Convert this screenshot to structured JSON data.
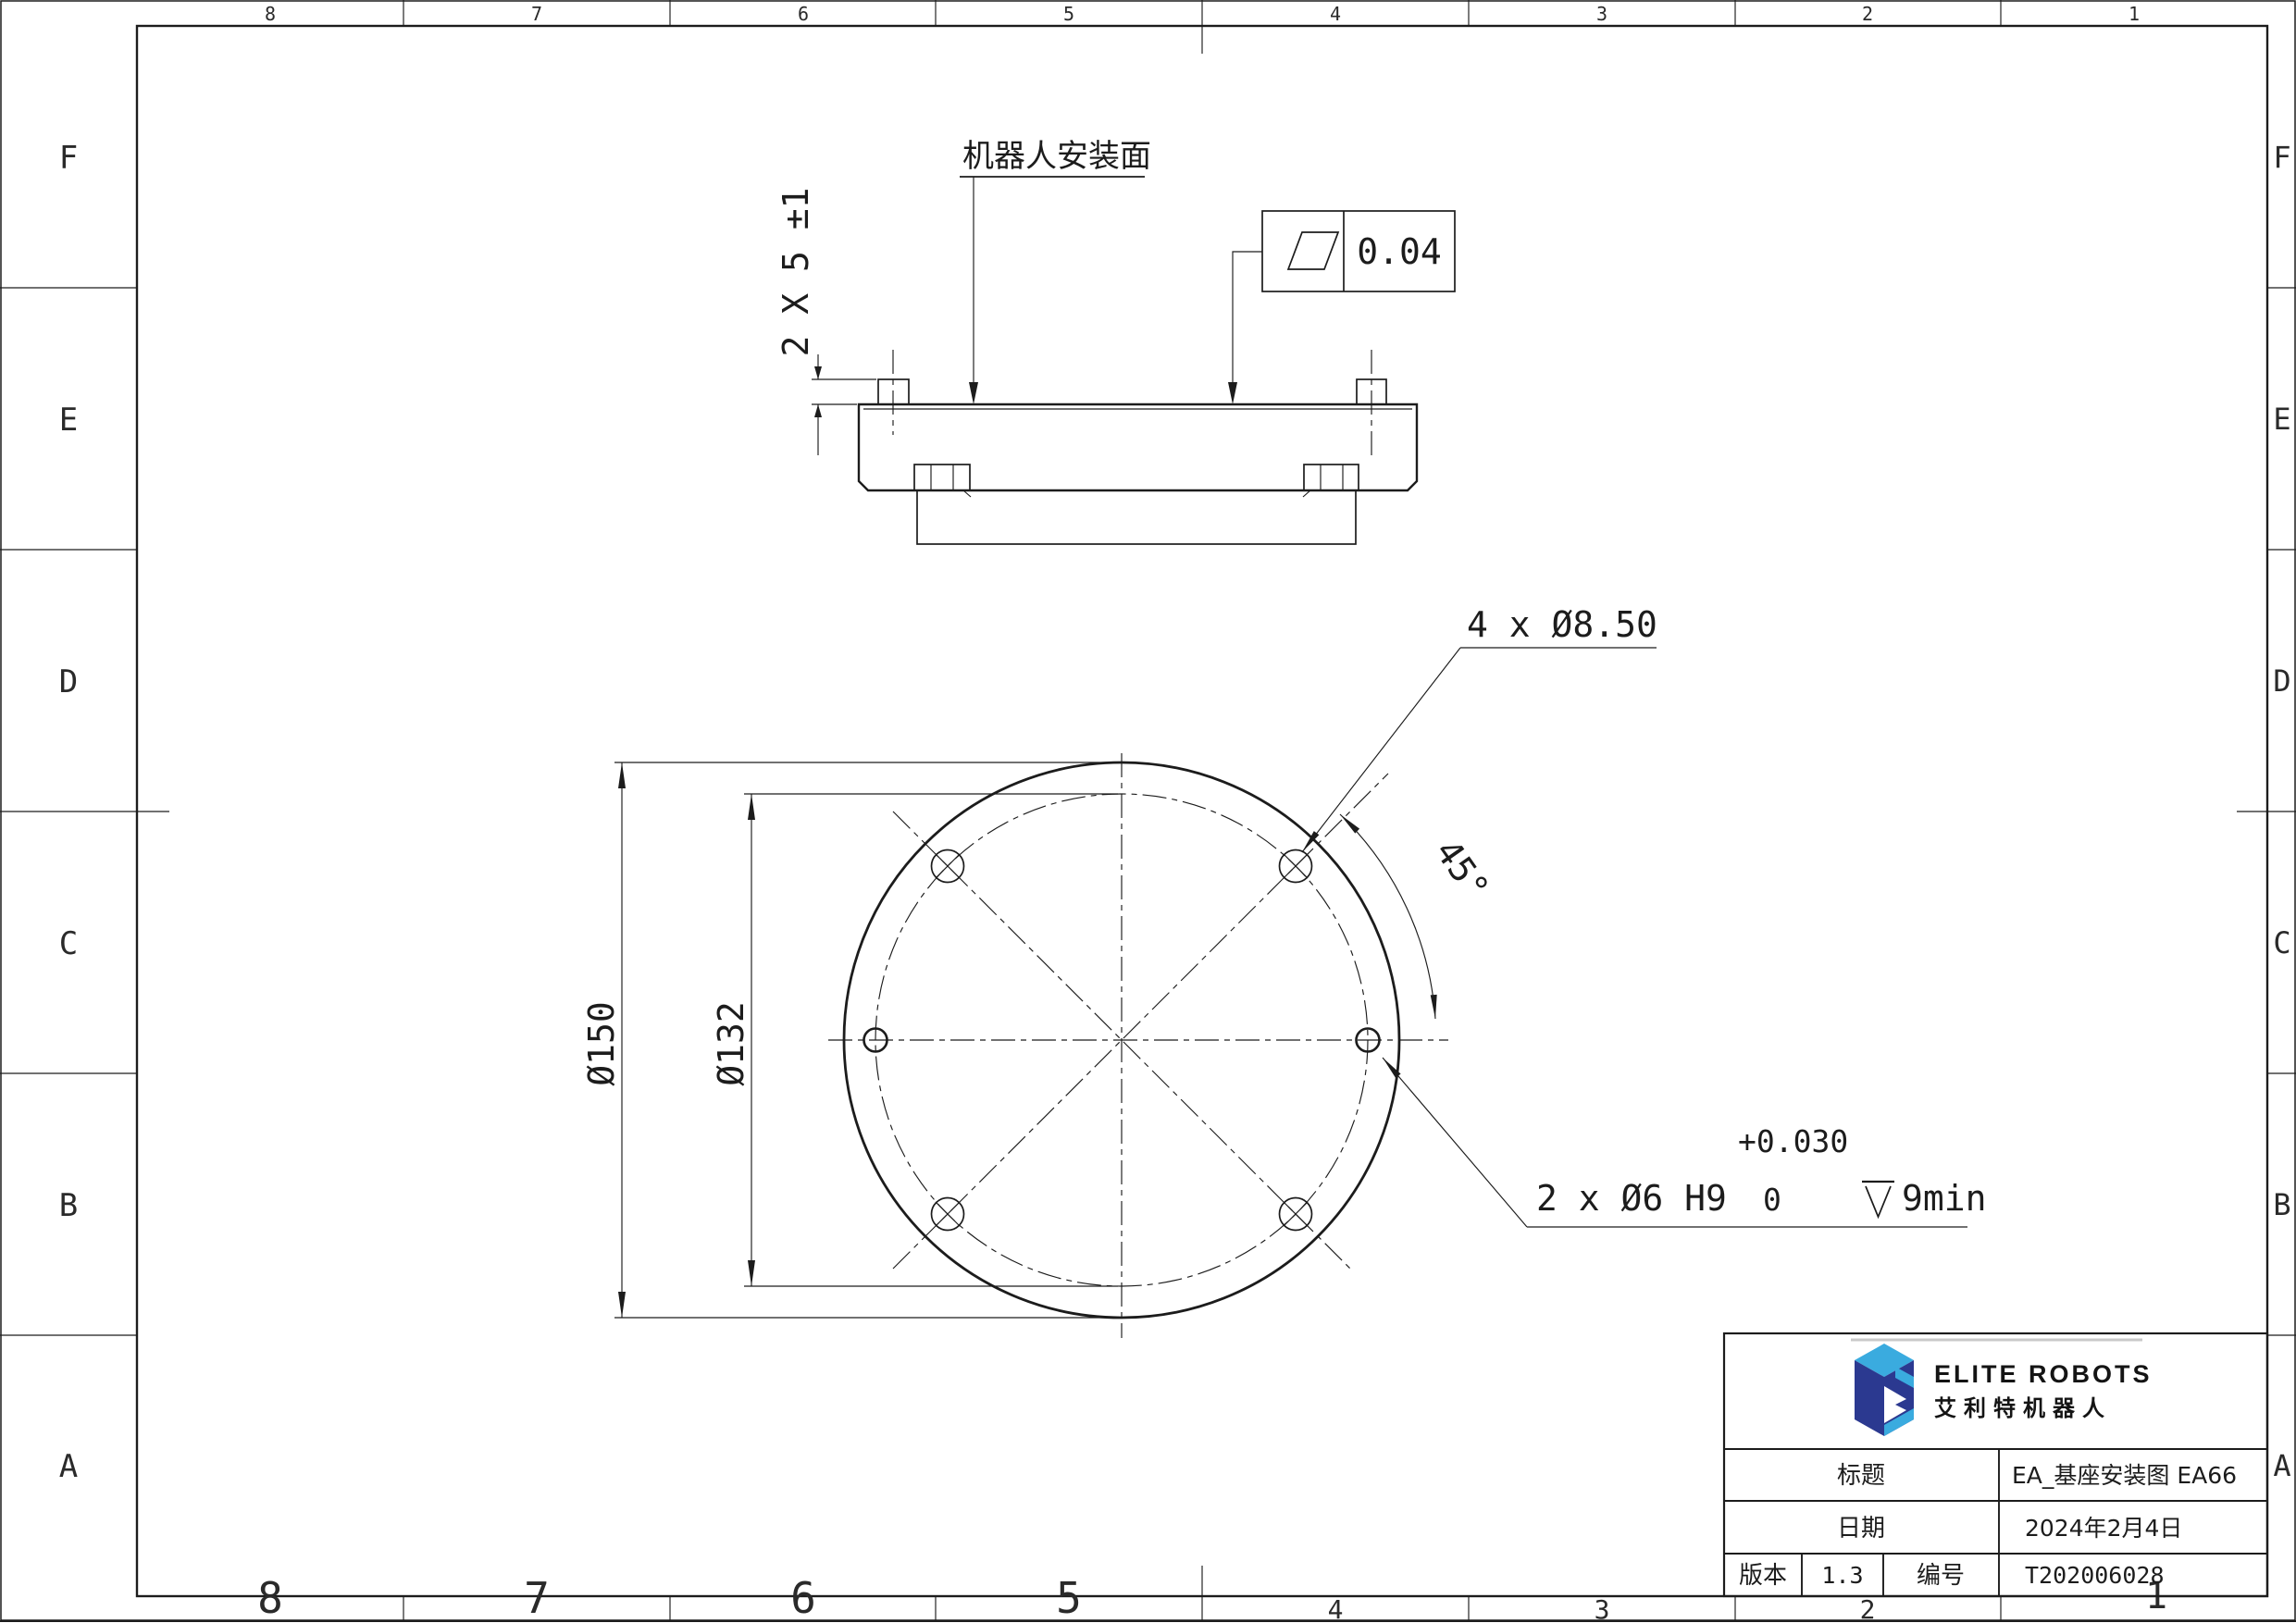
{
  "zones": {
    "cols": [
      "8",
      "7",
      "6",
      "5",
      "4",
      "3",
      "2",
      "1"
    ],
    "rows": [
      "F",
      "E",
      "D",
      "C",
      "B",
      "A"
    ]
  },
  "side_view": {
    "surface_label": "机器人安装面",
    "pin_dim": "2 X 5 ±1",
    "flatness_value": "0.04",
    "flatness_symbol_name": "flatness-parallelogram"
  },
  "top_view": {
    "hole_callout": "4 x Ø8.50",
    "angle_dim": "45°",
    "dia_outer": "Ø150",
    "dia_bolt_circle": "Ø132",
    "dowel_callout": "2 x Ø6 H9",
    "dowel_tol_upper": "+0.030",
    "dowel_tol_lower": "0",
    "dowel_depth": "9min",
    "depth_symbol_name": "depth-symbol"
  },
  "title_block": {
    "brand_en": "ELITE ROBOTS",
    "brand_cn": "艾利特机器人",
    "title_label": "标题",
    "title_value": "EA_基座安装图 EA66",
    "date_label": "日期",
    "date_value": "2024年2月4日",
    "version_label": "版本",
    "version_value": "1.3",
    "number_label": "编号",
    "number_value": "T202006028",
    "colors": {
      "logo_dark": "#2b3990",
      "logo_light": "#3aabdf",
      "accent_gray": "#c9c9c9"
    }
  }
}
